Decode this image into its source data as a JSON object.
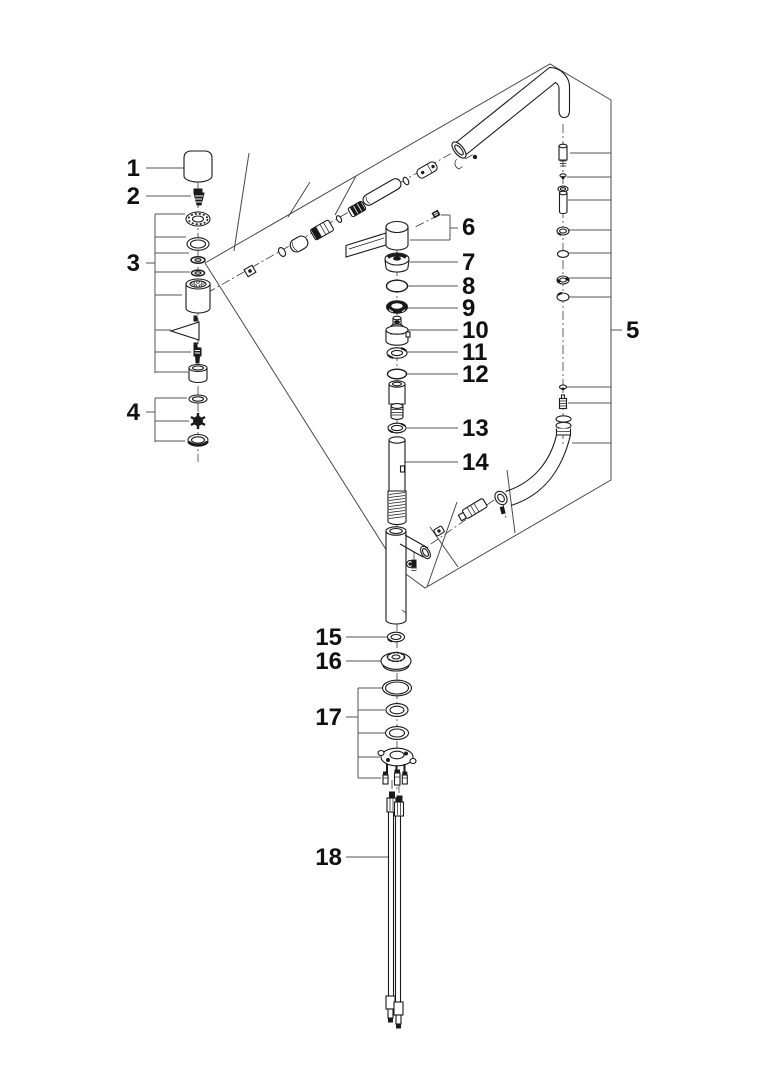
{
  "diagram": {
    "kind": "exploded-parts-diagram",
    "subject": "single-lever kitchen faucet with pull-out spray",
    "colors": {
      "ink": "#1a1a1a",
      "background": "#ffffff",
      "leader": "#555555"
    },
    "callouts": [
      {
        "number": "1",
        "part": "spray-cap"
      },
      {
        "number": "2",
        "part": "cap-screw"
      },
      {
        "number": "3",
        "part": "spray-head-parts-group"
      },
      {
        "number": "4",
        "part": "aerator-parts-group"
      },
      {
        "number": "5",
        "part": "spout-and-hose-assembly"
      },
      {
        "number": "6",
        "part": "lever-handle-with-set-screw"
      },
      {
        "number": "7",
        "part": "handle-escutcheon-cap"
      },
      {
        "number": "8",
        "part": "o-ring"
      },
      {
        "number": "9",
        "part": "ring-nut"
      },
      {
        "number": "10",
        "part": "cartridge"
      },
      {
        "number": "11",
        "part": "spacer-ring"
      },
      {
        "number": "12",
        "part": "o-ring"
      },
      {
        "number": "13",
        "part": "washer"
      },
      {
        "number": "14",
        "part": "riser-tube"
      },
      {
        "number": "15",
        "part": "lock-ring"
      },
      {
        "number": "16",
        "part": "base-escutcheon"
      },
      {
        "number": "17",
        "part": "mounting-hardware-group"
      },
      {
        "number": "18",
        "part": "supply-hoses"
      }
    ]
  }
}
